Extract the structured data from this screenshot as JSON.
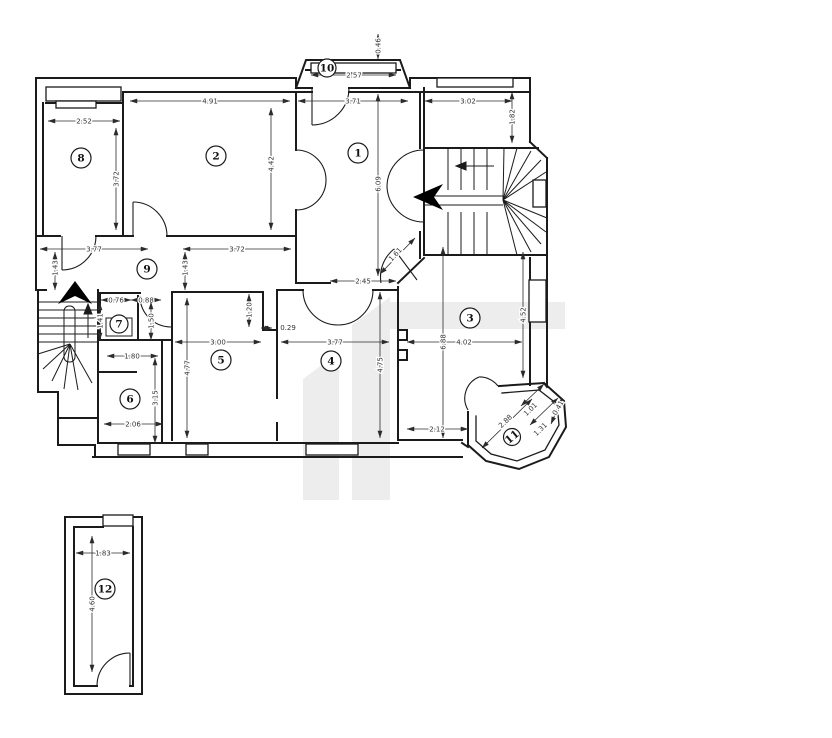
{
  "drawing": {
    "type": "architectural floor plan",
    "background": "#ffffff",
    "wall_color": "#1b1b1b",
    "dim_color": "#333333",
    "watermark_color": "#ededed"
  },
  "rooms": [
    {
      "label": "1",
      "x": 358,
      "y": 153,
      "r": 10
    },
    {
      "label": "2",
      "x": 216,
      "y": 156,
      "r": 10
    },
    {
      "label": "3",
      "x": 470,
      "y": 318,
      "r": 10
    },
    {
      "label": "4",
      "x": 331,
      "y": 361,
      "r": 10
    },
    {
      "label": "5",
      "x": 221,
      "y": 360,
      "r": 10
    },
    {
      "label": "6",
      "x": 130,
      "y": 399,
      "r": 10
    },
    {
      "label": "7",
      "x": 119,
      "y": 324,
      "r": 9
    },
    {
      "label": "8",
      "x": 81,
      "y": 158,
      "r": 10
    },
    {
      "label": "9",
      "x": 147,
      "y": 269,
      "r": 10
    },
    {
      "label": "10",
      "x": 327,
      "y": 68,
      "r": 9
    },
    {
      "label": "11",
      "x": 512,
      "y": 437,
      "r": 8.5,
      "rotate": -40
    },
    {
      "label": "12",
      "x": 105,
      "y": 589,
      "r": 10
    }
  ],
  "dimensions": [
    {
      "value": "0.46",
      "x": 380.5,
      "y": 46,
      "rotate": -90,
      "line": [
        378,
        34,
        378,
        59
      ]
    },
    {
      "value": "2.57",
      "x": 354,
      "y": 77.5,
      "line": [
        311,
        75,
        396,
        75
      ]
    },
    {
      "value": "3.71",
      "x": 353,
      "y": 103.5,
      "line": [
        298,
        101,
        408,
        101
      ]
    },
    {
      "value": "4.91",
      "x": 210,
      "y": 103.5,
      "line": [
        130,
        101,
        290,
        101
      ]
    },
    {
      "value": "3.02",
      "x": 468,
      "y": 103.5,
      "line": [
        425,
        101,
        512,
        101
      ]
    },
    {
      "value": "1.82",
      "x": 514.5,
      "y": 117,
      "rotate": -90,
      "line": [
        512,
        92,
        512,
        143
      ]
    },
    {
      "value": "2.52",
      "x": 84,
      "y": 123.5,
      "line": [
        48,
        121,
        120,
        121
      ]
    },
    {
      "value": "3.72",
      "x": 118.5,
      "y": 179,
      "rotate": -90,
      "line": [
        116,
        128,
        116,
        230
      ]
    },
    {
      "value": "4.42",
      "x": 273.5,
      "y": 164,
      "rotate": -90,
      "line": [
        271,
        108,
        271,
        230
      ]
    },
    {
      "value": "6.09",
      "x": 380.5,
      "y": 184,
      "rotate": -90,
      "line": [
        378,
        94,
        378,
        276
      ]
    },
    {
      "value": "3.77",
      "x": 94,
      "y": 251.5,
      "line": [
        40,
        249,
        148,
        249
      ]
    },
    {
      "value": "3.72",
      "x": 237,
      "y": 251.5,
      "line": [
        183,
        249,
        291,
        249
      ]
    },
    {
      "value": "1.43",
      "x": 57.5,
      "y": 268,
      "rotate": -90,
      "line": [
        55,
        252,
        55,
        290
      ]
    },
    {
      "value": "1.43",
      "x": 187.5,
      "y": 268,
      "rotate": -90,
      "line": [
        185,
        252,
        185,
        290
      ]
    },
    {
      "value": "2.45",
      "x": 363,
      "y": 283.5,
      "line": [
        330,
        281,
        396,
        281
      ]
    },
    {
      "value": "1.61",
      "x": 397,
      "y": 256,
      "rotate": -47,
      "line": [
        380,
        274,
        415,
        238
      ]
    },
    {
      "value": "0.76",
      "x": 116,
      "y": 302.5,
      "line": [
        101,
        300,
        131,
        300
      ]
    },
    {
      "value": "0.88",
      "x": 146,
      "y": 302.5,
      "line": [
        131,
        300,
        161,
        300
      ]
    },
    {
      "value": "1.41",
      "x": 102.5,
      "y": 321,
      "rotate": -90,
      "line": [
        100,
        303,
        100,
        340
      ]
    },
    {
      "value": "1.50",
      "x": 153.5,
      "y": 321,
      "rotate": -90,
      "line": [
        151,
        302,
        151,
        340
      ]
    },
    {
      "value": "1.80",
      "x": 132,
      "y": 358.5,
      "line": [
        107,
        356,
        158,
        356
      ]
    },
    {
      "value": "3.15",
      "x": 157.5,
      "y": 398,
      "rotate": -90,
      "line": [
        155,
        358,
        155,
        443
      ]
    },
    {
      "value": "2.06",
      "x": 133,
      "y": 426.5,
      "line": [
        104,
        424,
        163,
        424
      ]
    },
    {
      "value": "4.77",
      "x": 189.5,
      "y": 368,
      "rotate": -90,
      "line": [
        187,
        298,
        187,
        438
      ]
    },
    {
      "value": "3.00",
      "x": 218,
      "y": 344.5,
      "line": [
        175,
        342,
        261,
        342
      ]
    },
    {
      "value": "1.20",
      "x": 251.5,
      "y": 310,
      "rotate": -90,
      "line": [
        249,
        294,
        249,
        327
      ]
    },
    {
      "value": "0.29",
      "x": 288,
      "y": 330,
      "line": [
        261,
        328,
        272,
        328
      ]
    },
    {
      "value": "3.77",
      "x": 335,
      "y": 344.5,
      "line": [
        281,
        342,
        389,
        342
      ]
    },
    {
      "value": "4.75",
      "x": 382.5,
      "y": 365,
      "rotate": -90,
      "line": [
        380,
        292,
        380,
        438
      ]
    },
    {
      "value": "4.02",
      "x": 464,
      "y": 344.5,
      "line": [
        407,
        342,
        522,
        342
      ]
    },
    {
      "value": "6.88",
      "x": 445.5,
      "y": 342,
      "rotate": -90,
      "line": [
        443,
        247,
        443,
        438
      ]
    },
    {
      "value": "4.52",
      "x": 525.5,
      "y": 315,
      "rotate": -90,
      "line": [
        523,
        252,
        523,
        378
      ]
    },
    {
      "value": "2.12",
      "x": 437,
      "y": 431.5,
      "line": [
        407,
        429,
        468,
        429
      ]
    },
    {
      "value": "2.88",
      "x": 507,
      "y": 423,
      "rotate": -44,
      "line": [
        482,
        448,
        532,
        399
      ]
    },
    {
      "value": "1.01",
      "x": 532,
      "y": 411,
      "rotate": -44,
      "line": [
        521,
        406,
        544,
        384
      ]
    },
    {
      "value": "1.31",
      "x": 542,
      "y": 431,
      "rotate": -44,
      "line": [
        530,
        425,
        558,
        398
      ]
    },
    {
      "value": "0.41",
      "x": 560,
      "y": 409,
      "rotate": -60,
      "line": [
        551,
        424,
        562,
        398
      ]
    },
    {
      "value": "1.83",
      "x": 103,
      "y": 555.5,
      "line": [
        76,
        553,
        130,
        553
      ]
    },
    {
      "value": "4.60",
      "x": 94.5,
      "y": 604,
      "rotate": -90,
      "line": [
        92,
        536,
        92,
        672
      ]
    }
  ]
}
